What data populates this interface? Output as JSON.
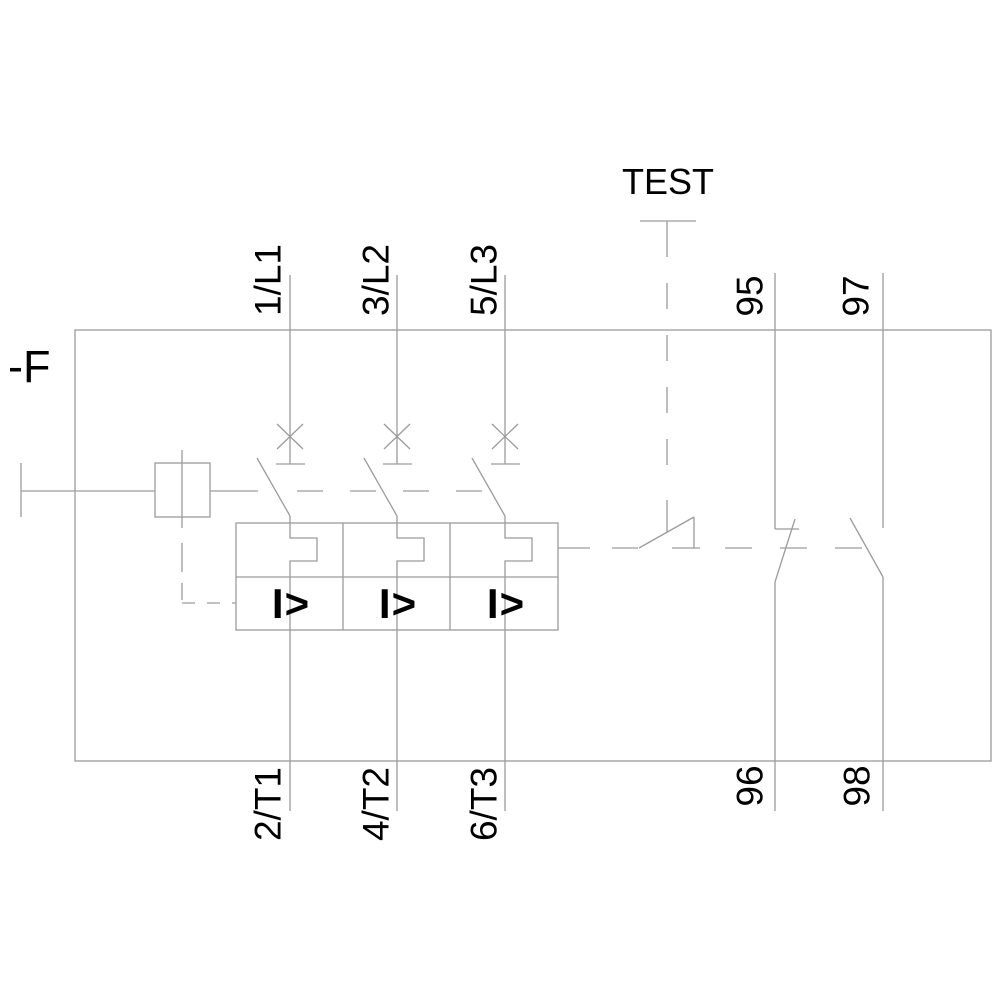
{
  "labels": {
    "designation": "-F",
    "test": "TEST",
    "top_terminals": [
      "1/L1",
      "3/L2",
      "5/L3"
    ],
    "bottom_terminals": [
      "2/T1",
      "4/T2",
      "6/T3"
    ],
    "aux_top": [
      "95",
      "97"
    ],
    "aux_bottom": [
      "96",
      "98"
    ],
    "overload": [
      "I>",
      "I>",
      "I>"
    ]
  },
  "colors": {
    "line": "#9c9c9c",
    "text": "#000000",
    "background": "#ffffff"
  }
}
